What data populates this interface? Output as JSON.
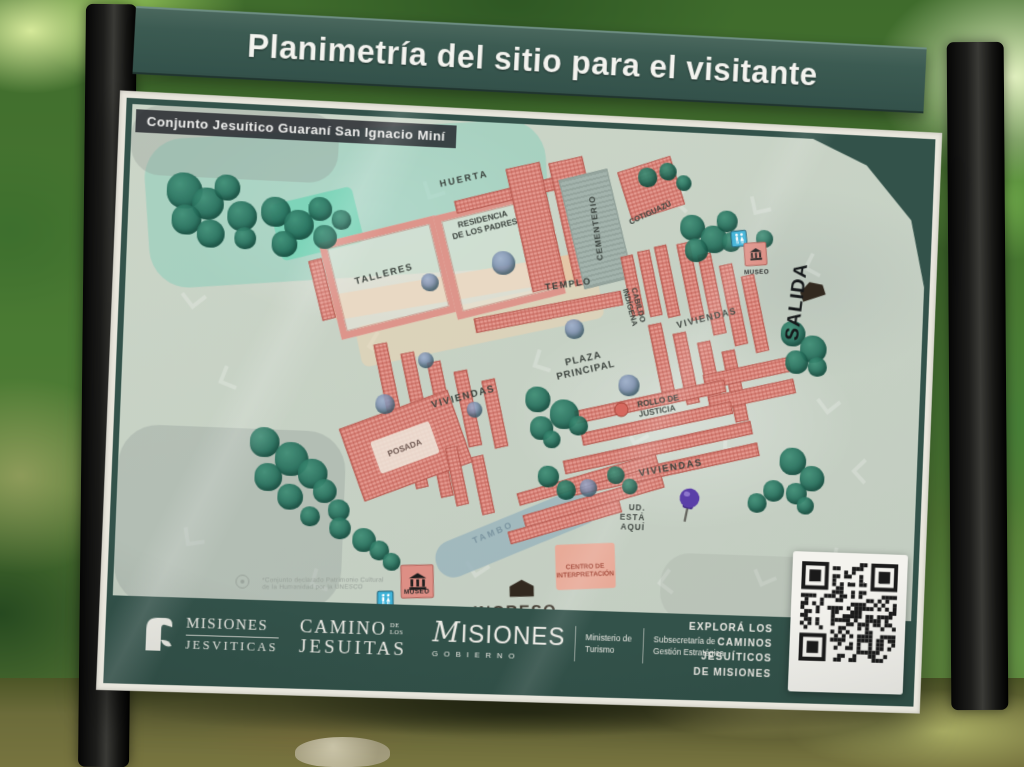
{
  "sign": {
    "title": "Planimetría del sitio para el visitante",
    "map_title": "Conjunto Jesuítico Guaraní San Ignacio Miní"
  },
  "colors": {
    "board_green": "#33524a",
    "map_base": "#c8d2c5",
    "building_pink": "#df968c",
    "tree_teal": "#2a6f5e",
    "huerta_aqua": "#7fd0b8",
    "restroom_blue": "#3fb3d8",
    "pushpin_purple": "#5a3fa8",
    "label_dark": "#3a413c"
  },
  "map": {
    "zones": [
      {
        "n": "huerta-wash",
        "x": 18,
        "y": 14,
        "w": 410,
        "h": 150,
        "r": -6,
        "c": "rgba(133,206,185,0.5)",
        "br": 40
      },
      {
        "n": "huerta-mint",
        "x": 148,
        "y": 82,
        "w": 86,
        "h": 58,
        "r": -16,
        "c": "rgba(118,212,182,0.85)",
        "br": 6
      },
      {
        "n": "gray-nw",
        "x": 0,
        "y": 0,
        "w": 210,
        "h": 70,
        "r": 0,
        "c": "rgba(148,158,152,0.35)",
        "br": 30
      },
      {
        "n": "gray-sw",
        "x": 0,
        "y": 320,
        "w": 230,
        "h": 180,
        "r": 0,
        "c": "rgba(150,160,154,0.38)",
        "br": 40
      },
      {
        "n": "path-tan",
        "x": 208,
        "y": 152,
        "w": 288,
        "h": 26,
        "r": -12,
        "c": "rgba(233,196,160,0.85)",
        "br": 4
      },
      {
        "n": "path-tan-wide",
        "x": 235,
        "y": 182,
        "w": 255,
        "h": 42,
        "r": -14,
        "c": "rgba(240,211,176,0.5)",
        "br": 8
      },
      {
        "n": "tambo-water",
        "x": 320,
        "y": 396,
        "w": 178,
        "h": 38,
        "r": -24,
        "c": "rgba(157,182,189,0.9)",
        "br": 18
      },
      {
        "n": "centro-interpretacion-bldg",
        "x": 450,
        "y": 424,
        "w": 62,
        "h": 46,
        "r": -4,
        "c": "rgba(236,166,147,0.9)",
        "br": 3
      },
      {
        "n": "gray-se-wash",
        "x": 560,
        "y": 430,
        "w": 240,
        "h": 70,
        "r": 0,
        "c": "rgba(160,168,160,0.25)",
        "br": 30
      }
    ],
    "overlays": [
      {
        "n": "posada-patch",
        "x": 258,
        "y": 316,
        "w": 64,
        "h": 34,
        "r": -22,
        "c": "rgba(238,232,220,0.85)",
        "br": 3
      }
    ],
    "buildings": [
      [
        205,
        112,
        122,
        100,
        -16,
        "o"
      ],
      [
        322,
        80,
        115,
        108,
        -16,
        "o"
      ],
      [
        330,
        66,
        112,
        13,
        -16,
        "h"
      ],
      [
        192,
        146,
        14,
        62,
        -16,
        "h"
      ],
      [
        398,
        40,
        36,
        128,
        -15,
        "h"
      ],
      [
        442,
        32,
        36,
        128,
        -15,
        "h"
      ],
      [
        355,
        182,
        155,
        15,
        -13,
        "h"
      ],
      [
        452,
        46,
        52,
        114,
        -16,
        "g"
      ],
      [
        505,
        33,
        58,
        52,
        -20,
        "h"
      ],
      [
        512,
        128,
        13,
        62,
        -14,
        "h"
      ],
      [
        530,
        122,
        13,
        68,
        -14,
        "h"
      ],
      [
        548,
        116,
        13,
        74,
        -14,
        "h"
      ],
      [
        572,
        112,
        14,
        80,
        -14,
        "h"
      ],
      [
        595,
        122,
        14,
        84,
        -14,
        "h"
      ],
      [
        618,
        132,
        14,
        84,
        -14,
        "h"
      ],
      [
        641,
        142,
        14,
        80,
        -14,
        "h"
      ],
      [
        545,
        196,
        14,
        74,
        -14,
        "h"
      ],
      [
        571,
        204,
        14,
        74,
        -14,
        "h"
      ],
      [
        597,
        212,
        14,
        74,
        -14,
        "h"
      ],
      [
        623,
        220,
        14,
        74,
        -14,
        "h"
      ],
      [
        596,
        236,
        92,
        15,
        -14,
        "h"
      ],
      [
        602,
        258,
        92,
        15,
        -14,
        "h"
      ],
      [
        462,
        270,
        160,
        13,
        -14,
        "h"
      ],
      [
        470,
        292,
        160,
        13,
        -14,
        "h"
      ],
      [
        452,
        316,
        200,
        14,
        -14,
        "h"
      ],
      [
        460,
        338,
        200,
        14,
        -14,
        "h"
      ],
      [
        262,
        228,
        14,
        72,
        -14,
        "h"
      ],
      [
        290,
        236,
        14,
        72,
        -14,
        "h"
      ],
      [
        318,
        244,
        14,
        76,
        -14,
        "h"
      ],
      [
        346,
        252,
        14,
        78,
        -14,
        "h"
      ],
      [
        374,
        260,
        14,
        70,
        -14,
        "h"
      ],
      [
        296,
        316,
        13,
        58,
        -14,
        "h"
      ],
      [
        322,
        324,
        13,
        58,
        -14,
        "h"
      ],
      [
        232,
        292,
        118,
        78,
        -22,
        "h"
      ],
      [
        405,
        352,
        150,
        13,
        -18,
        "h"
      ],
      [
        412,
        374,
        150,
        13,
        -18,
        "h"
      ],
      [
        398,
        396,
        120,
        13,
        -18,
        "h"
      ],
      [
        365,
        338,
        13,
        60,
        -14,
        "h"
      ],
      [
        338,
        330,
        13,
        60,
        -14,
        "h"
      ]
    ],
    "trees": [
      [
        38,
        66,
        36
      ],
      [
        64,
        80,
        32
      ],
      [
        44,
        98,
        30
      ],
      [
        86,
        66,
        26
      ],
      [
        100,
        92,
        30
      ],
      [
        70,
        112,
        28
      ],
      [
        108,
        118,
        22
      ],
      [
        134,
        86,
        30
      ],
      [
        158,
        98,
        30
      ],
      [
        146,
        120,
        26
      ],
      [
        182,
        84,
        24
      ],
      [
        188,
        112,
        24
      ],
      [
        206,
        96,
        20
      ],
      [
        520,
        38,
        20
      ],
      [
        542,
        32,
        18
      ],
      [
        560,
        44,
        16
      ],
      [
        566,
        84,
        26
      ],
      [
        588,
        94,
        28
      ],
      [
        572,
        108,
        24
      ],
      [
        604,
        78,
        22
      ],
      [
        610,
        100,
        20
      ],
      [
        646,
        96,
        18
      ],
      [
        676,
        188,
        26
      ],
      [
        697,
        202,
        28
      ],
      [
        682,
        218,
        24
      ],
      [
        706,
        224,
        20
      ],
      [
        680,
        318,
        28
      ],
      [
        702,
        336,
        26
      ],
      [
        688,
        354,
        22
      ],
      [
        664,
        352,
        22
      ],
      [
        648,
        366,
        20
      ],
      [
        700,
        368,
        18
      ],
      [
        412,
        266,
        26
      ],
      [
        438,
        278,
        30
      ],
      [
        418,
        296,
        24
      ],
      [
        458,
        294,
        20
      ],
      [
        432,
        310,
        18
      ],
      [
        132,
        318,
        30
      ],
      [
        158,
        332,
        34
      ],
      [
        138,
        354,
        28
      ],
      [
        182,
        348,
        30
      ],
      [
        162,
        374,
        26
      ],
      [
        198,
        368,
        24
      ],
      [
        214,
        388,
        22
      ],
      [
        186,
        396,
        20
      ],
      [
        216,
        406,
        22
      ],
      [
        240,
        416,
        24
      ],
      [
        258,
        428,
        20
      ],
      [
        272,
        440,
        18
      ],
      [
        428,
        346,
        22
      ],
      [
        448,
        360,
        20
      ],
      [
        500,
        344,
        18
      ],
      [
        516,
        356,
        16
      ],
      [
        372,
        130,
        24,
        "b"
      ],
      [
        300,
        156,
        18,
        "b"
      ],
      [
        450,
        196,
        20,
        "b"
      ],
      [
        508,
        250,
        22,
        "b"
      ],
      [
        258,
        280,
        20,
        "b"
      ],
      [
        352,
        284,
        16,
        "b"
      ],
      [
        472,
        358,
        18,
        "b"
      ],
      [
        300,
        236,
        16,
        "b"
      ]
    ],
    "watermarks": [
      [
        60,
        180,
        -40
      ],
      [
        100,
        260,
        20
      ],
      [
        70,
        420,
        -10
      ],
      [
        250,
        220,
        30
      ],
      [
        300,
        60,
        -20
      ],
      [
        420,
        230,
        15
      ],
      [
        520,
        300,
        -30
      ],
      [
        560,
        60,
        40
      ],
      [
        640,
        60,
        -15
      ],
      [
        700,
        120,
        25
      ],
      [
        720,
        260,
        -40
      ],
      [
        740,
        420,
        10
      ],
      [
        660,
        440,
        -25
      ],
      [
        560,
        450,
        35
      ],
      [
        360,
        440,
        -35
      ],
      [
        200,
        460,
        15
      ],
      [
        620,
        305,
        0
      ],
      [
        760,
        330,
        45
      ]
    ],
    "icons": [
      {
        "t": "restroom",
        "x": 628,
        "y": 106,
        "s": 17,
        "r": -8
      },
      {
        "t": "museum",
        "x": 646,
        "y": 121,
        "s": 24,
        "r": -6
      },
      {
        "t": "museum",
        "x": 308,
        "y": 468,
        "s": 34,
        "r": -3
      },
      {
        "t": "restroom",
        "x": 276,
        "y": 487,
        "s": 17,
        "r": -2
      },
      {
        "t": "pushpin",
        "x": 585,
        "y": 384,
        "s": 38,
        "r": 10
      },
      {
        "t": "gate",
        "x": 416,
        "y": 474,
        "s": 27,
        "r": -3
      },
      {
        "t": "gate",
        "x": 708,
        "y": 158,
        "s": 27,
        "r": -20
      },
      {
        "t": "rollo",
        "x": 512,
        "y": 286,
        "s": 13,
        "r": 0
      },
      {
        "t": "unesco",
        "x": 130,
        "y": 474,
        "s": 12,
        "r": 0
      }
    ],
    "labels": [
      {
        "id": "huerta",
        "t": "HUERTA",
        "x": 340,
        "y": 60,
        "r": -15,
        "s": 9.5,
        "ls": 2
      },
      {
        "id": "residencia-de-los-padres",
        "t": "RESIDENCIA\nDE LOS PADRES",
        "x": 362,
        "y": 104,
        "r": -16,
        "s": 8.5
      },
      {
        "id": "talleres",
        "t": "TALLERES",
        "x": 262,
        "y": 160,
        "r": -17,
        "s": 9.5,
        "ls": 1.5
      },
      {
        "id": "cementerio",
        "t": "CEMENTERIO",
        "x": 479,
        "y": 102,
        "r": -100,
        "s": 8.5,
        "ls": 1
      },
      {
        "id": "cotiguazu",
        "t": "COTIGUAZÚ",
        "x": 534,
        "y": 84,
        "r": -27,
        "s": 8
      },
      {
        "id": "templo",
        "t": "TEMPLO",
        "x": 452,
        "y": 162,
        "r": -10,
        "s": 9.5,
        "ls": 1.5
      },
      {
        "id": "cabildo-indigena",
        "t": "CABILDO\nINDÍGENA",
        "x": 521,
        "y": 180,
        "r": 72,
        "s": 8
      },
      {
        "id": "viviendas-ne",
        "t": "VIVIENDAS",
        "x": 598,
        "y": 190,
        "r": -16,
        "s": 9.5,
        "ls": 1.5
      },
      {
        "id": "salida",
        "t": "SALIDA",
        "x": 692,
        "y": 168,
        "r": -85,
        "s": 20,
        "w": 900,
        "c": "#15181a",
        "ls": 1
      },
      {
        "id": "museo-ne",
        "t": "MUSEO",
        "x": 648,
        "y": 140,
        "r": -4,
        "s": 6.5,
        "c": "#2a2a2a",
        "ls": 0.5
      },
      {
        "id": "plaza-principal",
        "t": "PLAZA\nPRINCIPAL",
        "x": 472,
        "y": 242,
        "r": -15,
        "s": 10,
        "ls": 1
      },
      {
        "id": "rollo-de-justicia",
        "t": "ROLLO DE\nJUSTICIA",
        "x": 551,
        "y": 281,
        "r": -12,
        "s": 8.5,
        "a": "left"
      },
      {
        "id": "viviendas-centro",
        "t": "VIVIENDAS",
        "x": 566,
        "y": 344,
        "r": -12,
        "s": 10,
        "ls": 1.5
      },
      {
        "id": "viviendas-oeste",
        "t": "VIVIENDAS",
        "x": 348,
        "y": 280,
        "r": -17,
        "s": 10,
        "ls": 1.5
      },
      {
        "id": "posada",
        "t": "POSADA",
        "x": 290,
        "y": 334,
        "r": -23,
        "s": 8.5,
        "c": "#6b564f"
      },
      {
        "id": "tambo",
        "t": "TAMBO",
        "x": 384,
        "y": 416,
        "r": -25,
        "s": 9,
        "c": "#7c95a0",
        "ls": 2.5
      },
      {
        "id": "ud-esta-aqui",
        "t": "UD.\nESTÁ\nAQUÍ",
        "x": 528,
        "y": 396,
        "r": 0,
        "s": 8.5,
        "a": "right",
        "ls": 1
      },
      {
        "id": "centro-de-interpretacion",
        "t": "CENTRO DE\nINTERPRETACIÓN",
        "x": 481,
        "y": 452,
        "r": -4,
        "s": 6.8,
        "c": "#a34a3a"
      },
      {
        "id": "museo-sur",
        "t": "MUSEO",
        "x": 308,
        "y": 479,
        "r": -3,
        "s": 6.5,
        "c": "#242424",
        "ls": 0.5
      },
      {
        "id": "ingreso",
        "t": "INGRESO",
        "x": 410,
        "y": 496,
        "r": -3,
        "s": 16.5,
        "w": 900,
        "c": "#443d33",
        "ls": 1.5
      },
      {
        "id": "unesco-note",
        "t": "*Conjunto declarado Patrimonio Cultural\nde la Humanidad por la UNESCO",
        "x": 212,
        "y": 474,
        "r": -2,
        "s": 6.5,
        "c": "#99a29a",
        "w": 400,
        "a": "left",
        "ls": 0.2
      }
    ]
  },
  "footer": {
    "mj": {
      "line1": "MISIONES",
      "line2": "JESVITICAS"
    },
    "camino": {
      "line1": "CAMINO",
      "line1b": "DE\nLOS",
      "line2": "JESUITAS"
    },
    "gob": {
      "m": "M",
      "rest": "ISIONES",
      "sub": "GOBIERNO",
      "ministry": "Ministerio de Turismo",
      "secretary": "Subsecretaría de Gestión Estratégica"
    },
    "explora": [
      "EXPLORÁ LOS",
      "CAMINOS",
      "JESUÍTICOS",
      "DE MISIONES"
    ]
  }
}
